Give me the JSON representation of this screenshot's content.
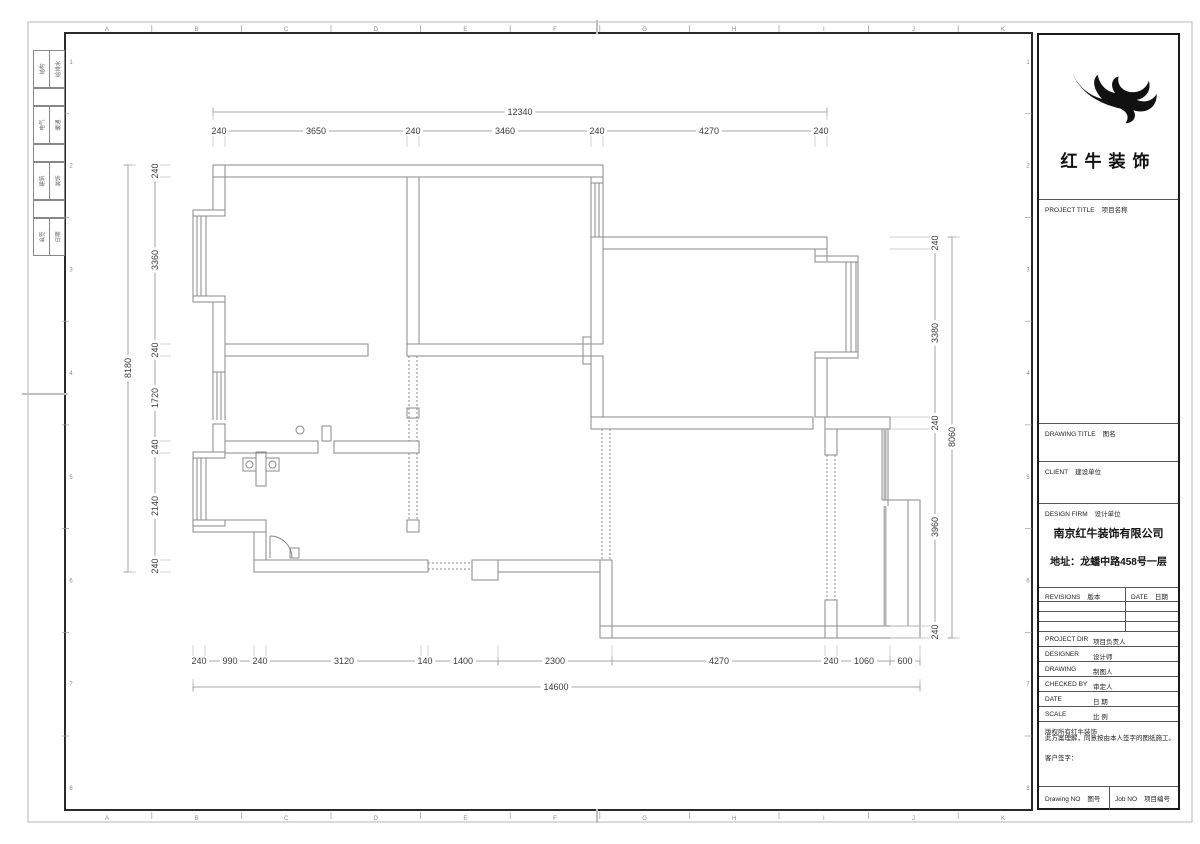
{
  "sheet": {
    "grid_letters": [
      "A",
      "B",
      "C",
      "D",
      "E",
      "F",
      "G",
      "H",
      "I",
      "J",
      "K"
    ],
    "grid_numbers": [
      "1",
      "2",
      "3",
      "4",
      "5",
      "6",
      "7",
      "8"
    ]
  },
  "signature_strip": {
    "rows": [
      {
        "c1": "结构",
        "c2": "给排水"
      },
      {
        "c1": "电气",
        "c2": "暖通"
      },
      {
        "c1": "建筑",
        "c2": "装饰"
      },
      {
        "c1": "会签",
        "c2": "日期"
      }
    ]
  },
  "dimensions": {
    "rows": [
      {
        "id": "top-overall",
        "dir": "h",
        "pos": 112,
        "ticks": [
          213,
          827
        ],
        "ext": 8,
        "labels": [
          {
            "t": "12340",
            "p": 520
          }
        ]
      },
      {
        "id": "top-segments",
        "dir": "h",
        "pos": 131,
        "ticks": [
          213,
          225,
          407,
          419,
          591,
          603,
          815,
          827
        ],
        "ext": 16,
        "labels": [
          {
            "t": "240",
            "p": 219
          },
          {
            "t": "3650",
            "p": 316
          },
          {
            "t": "240",
            "p": 413
          },
          {
            "t": "3460",
            "p": 505
          },
          {
            "t": "240",
            "p": 597
          },
          {
            "t": "4270",
            "p": 709
          },
          {
            "t": "240",
            "p": 821
          }
        ]
      },
      {
        "id": "left-overall",
        "dir": "v",
        "pos": 128,
        "ticks": [
          165,
          572
        ],
        "ext": 8,
        "labels": [
          {
            "t": "8180",
            "p": 368
          }
        ]
      },
      {
        "id": "left-segments",
        "dir": "v",
        "pos": 155,
        "ticks": [
          165,
          177,
          344,
          356,
          441,
          453,
          560,
          572
        ],
        "ext": 16,
        "labels": [
          {
            "t": "240",
            "p": 171
          },
          {
            "t": "3360",
            "p": 260
          },
          {
            "t": "240",
            "p": 350
          },
          {
            "t": "1720",
            "p": 398
          },
          {
            "t": "240",
            "p": 447
          },
          {
            "t": "2140",
            "p": 506
          },
          {
            "t": "240",
            "p": 566
          }
        ]
      },
      {
        "id": "right-segments",
        "dir": "v",
        "pos": 935,
        "ticks": [
          237,
          249,
          417,
          429,
          626,
          638
        ],
        "ext": -45,
        "labels": [
          {
            "t": "240",
            "p": 243
          },
          {
            "t": "3380",
            "p": 333
          },
          {
            "t": "240",
            "p": 423
          },
          {
            "t": "3960",
            "p": 527
          },
          {
            "t": "240",
            "p": 632
          }
        ]
      },
      {
        "id": "right-overall",
        "dir": "v",
        "pos": 952,
        "ticks": [
          237,
          638
        ],
        "ext": 8,
        "labels": [
          {
            "t": "8060",
            "p": 437
          }
        ]
      },
      {
        "id": "bottom-segments",
        "dir": "h",
        "pos": 661,
        "ticks": [
          193,
          205,
          254,
          266,
          421,
          428,
          498,
          612,
          825,
          837,
          890,
          920
        ],
        "ext": -16,
        "labels": [
          {
            "t": "240",
            "p": 199
          },
          {
            "t": "990",
            "p": 230
          },
          {
            "t": "240",
            "p": 260
          },
          {
            "t": "3120",
            "p": 344
          },
          {
            "t": "140",
            "p": 425
          },
          {
            "t": "1400",
            "p": 463
          },
          {
            "t": "2300",
            "p": 555
          },
          {
            "t": "4270",
            "p": 719
          },
          {
            "t": "240",
            "p": 831
          },
          {
            "t": "1060",
            "p": 864
          },
          {
            "t": "600",
            "p": 905
          }
        ]
      },
      {
        "id": "bottom-overall",
        "dir": "h",
        "pos": 687,
        "ticks": [
          193,
          920
        ],
        "ext": -8,
        "labels": [
          {
            "t": "14600",
            "p": 556
          }
        ]
      }
    ]
  },
  "title_block": {
    "logo_text": "红牛装饰",
    "sections": [
      {
        "en": "PROJECT TITLE",
        "zh": "项目名称"
      },
      {
        "en": "DRAWING TITLE",
        "zh": "图名"
      },
      {
        "en": "CLIENT",
        "zh": "建设单位"
      },
      {
        "en": "DESIGN FIRM",
        "zh": "设计单位"
      }
    ],
    "company": "南京红牛装饰有限公司",
    "address": "地址：龙蟠中路458号一层",
    "revisions": {
      "en": "REVISIONS",
      "zh": "版本"
    },
    "date_col": {
      "en": "DATE",
      "zh": "日期"
    },
    "fields": [
      {
        "en": "PROJECT DIR",
        "zh": "项目负责人"
      },
      {
        "en": "DESIGNER",
        "zh": "设计师"
      },
      {
        "en": "DRAWING",
        "zh": "制图人"
      },
      {
        "en": "CHECKED BY",
        "zh": "审定人"
      },
      {
        "en": "DATE",
        "zh": "日  期"
      },
      {
        "en": "SCALE",
        "zh": "比  例"
      }
    ],
    "disclaimer1": "版权所有红牛装饰",
    "disclaimer2": "此方案理解，同意按由本人签字的图纸施工。",
    "signature_label": "客户签字：",
    "drawing_no": {
      "en": "Drawing NO",
      "zh": "图号"
    },
    "job_no": {
      "en": "Job NO",
      "zh": "项目编号"
    }
  },
  "colors": {
    "plan_line": "#8a8a8a",
    "dim_text": "#3a3a3a",
    "frame": "#2a2a2a",
    "glazing": "#b3b3b3"
  }
}
